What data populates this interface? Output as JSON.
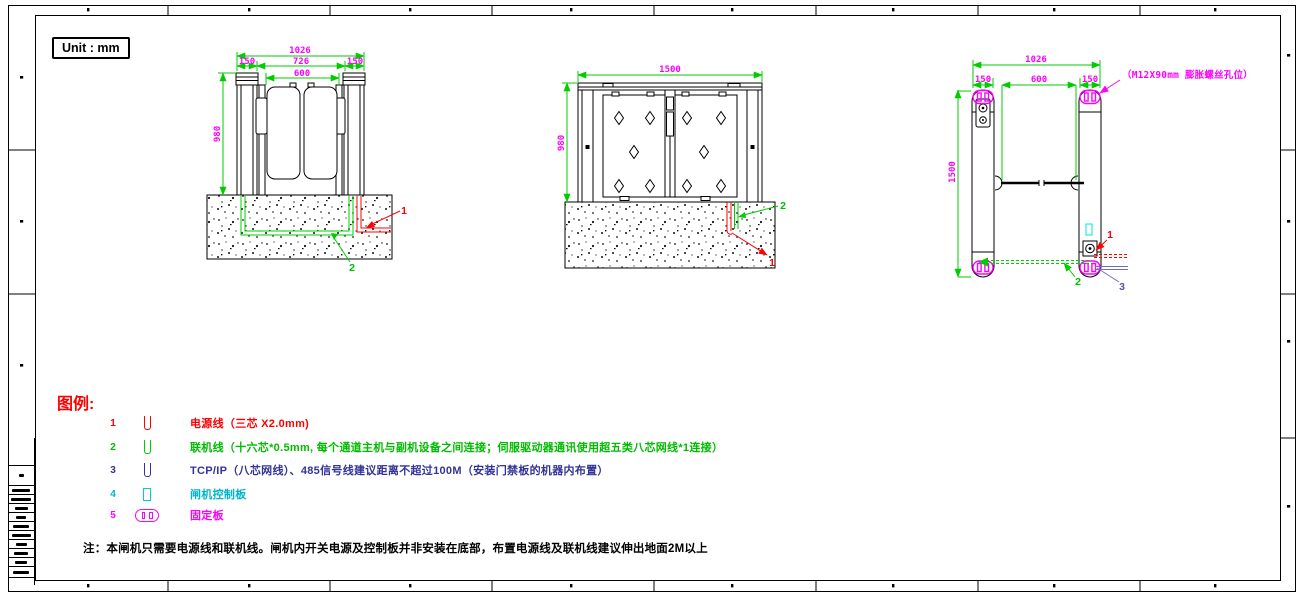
{
  "unit_label": "Unit : mm",
  "front_dims": {
    "total": "1026",
    "seg_left": "150",
    "seg_mid": "726",
    "seg_right": "150",
    "inner": "600",
    "height": "980"
  },
  "rear_dims": {
    "width": "1500",
    "height": "980"
  },
  "plan_dims": {
    "total": "1026",
    "seg_left": "150",
    "seg_mid": "600",
    "seg_right": "150",
    "length": "1500",
    "bolt_note": "（M12X90mm 膨胀螺丝孔位）"
  },
  "callouts": {
    "power": "1",
    "network": "2",
    "tcpip": "3"
  },
  "legend": {
    "title": "图例:",
    "items": [
      {
        "num": "1",
        "text": "电源线（三芯 X2.0mm)",
        "color": "#ff0000"
      },
      {
        "num": "2",
        "text": "联机线（十六芯*0.5mm, 每个通道主机与副机设备之间连接；伺服驱动器通讯使用超五类八芯网线*1连接）",
        "color": "#00cc00"
      },
      {
        "num": "3",
        "text": "TCP/IP（八芯网线）、485信号线建议距离不超过100M（安装门禁板的机器内布置）",
        "color": "#333399"
      },
      {
        "num": "4",
        "text": "闸机控制板",
        "color": "#00cfcf"
      },
      {
        "num": "5",
        "text": "固定板",
        "color": "#ff00ff"
      }
    ]
  },
  "note": "注：本闸机只需要电源线和联机线。闸机内开关电源及控制板并非安装在底部，布置电源线及联机线建议伸出地面2M以上",
  "colors": {
    "dim_line": "#00cc00",
    "dim_text": "#ff00ff",
    "power": "#ff0000",
    "network": "#00cc00",
    "tcpip": "#333399",
    "control_board": "#00e5e5",
    "fixing_plate": "#ff00ff"
  }
}
